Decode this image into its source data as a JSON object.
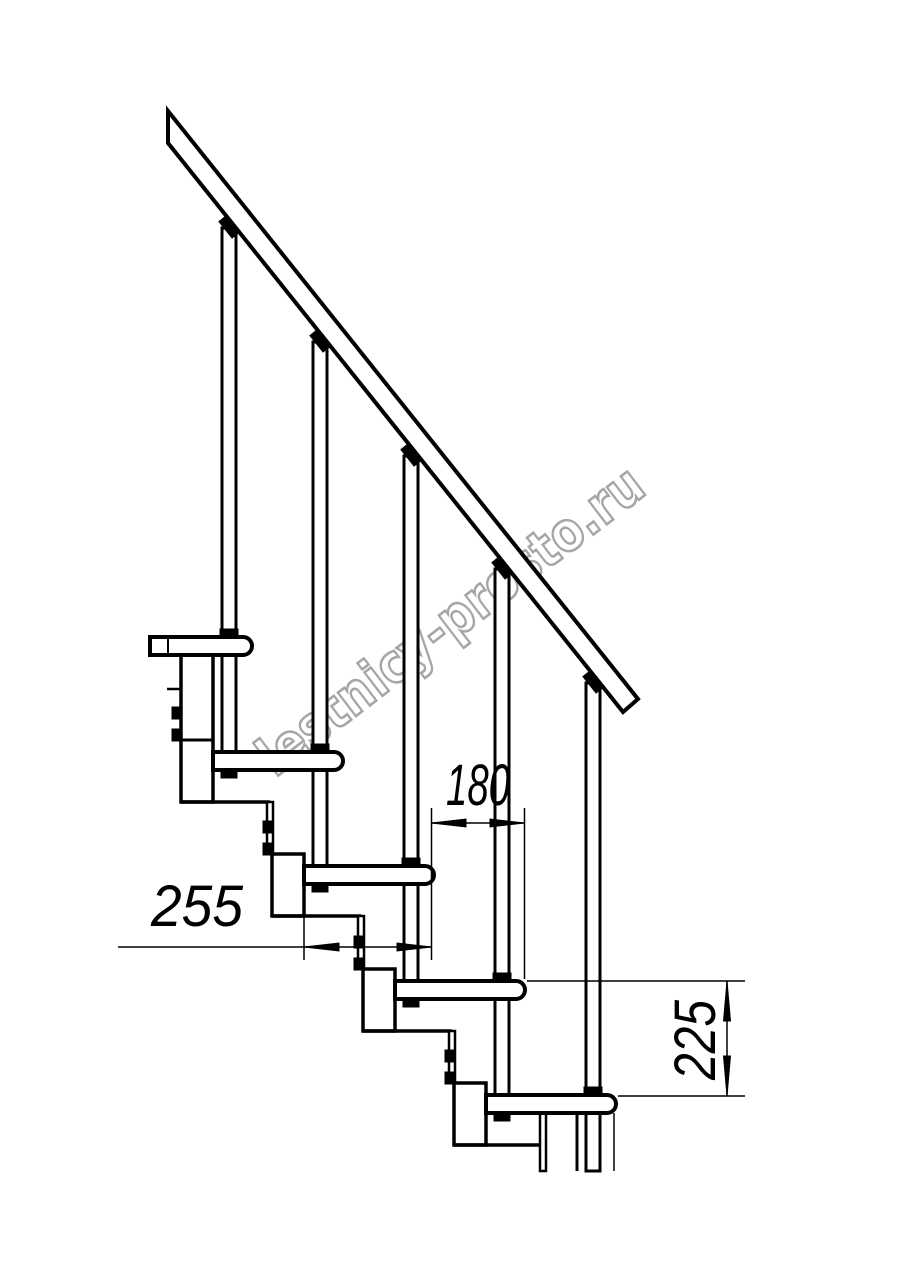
{
  "watermark": {
    "text": "lestnicy-prosto.ru",
    "color": "#a6a6a6",
    "fill": "#ffffff",
    "x": 275,
    "y": 778,
    "angle": -37.4,
    "font_size": 54,
    "text_length": 470,
    "stroke_width": 2.6
  },
  "drawing": {
    "line_color": "#000000",
    "background": "#ffffff",
    "handrail": {
      "points": "168,111 638,699 623,712 168,143"
    },
    "rail_angle_deg": 51.3,
    "steps": [
      {
        "t": 637,
        "l": 150,
        "r": 252
      },
      {
        "t": 752,
        "l": 213,
        "r": 343
      },
      {
        "t": 866,
        "l": 304,
        "r": 434
      },
      {
        "t": 981,
        "l": 395,
        "r": 525
      },
      {
        "t": 1095,
        "l": 486,
        "r": 616
      }
    ],
    "step_height": 18,
    "nose_radius": 9,
    "balusters": [
      {
        "axis": 229,
        "top": 228,
        "bottom": 754
      },
      {
        "axis": 320,
        "top": 342,
        "bottom": 868
      },
      {
        "axis": 411,
        "top": 456,
        "bottom": 983
      },
      {
        "axis": 502,
        "top": 569,
        "bottom": 1097
      },
      {
        "axis": 593,
        "top": 683,
        "bottom": 1171
      }
    ],
    "columns": [
      {
        "x": 181,
        "y": 655,
        "w": 32,
        "h": 147,
        "mid": 740
      },
      {
        "x": 272,
        "y": 854,
        "w": 32,
        "h": 62
      },
      {
        "x": 363,
        "y": 969,
        "w": 32,
        "h": 62
      },
      {
        "x": 454,
        "y": 1083,
        "w": 32,
        "h": 62
      }
    ],
    "bracket_reach": 89,
    "plates": [
      {
        "x": 267,
        "y": 802,
        "h": 52
      },
      {
        "x": 358,
        "y": 916,
        "h": 53
      },
      {
        "x": 449,
        "y": 1031,
        "h": 52
      },
      {
        "x": 540,
        "y": 1113,
        "h": 58
      }
    ],
    "tabs": [
      [
        172,
        707
      ],
      [
        172,
        729
      ],
      [
        263,
        821
      ],
      [
        263,
        843
      ],
      [
        354,
        936
      ],
      [
        354,
        958
      ],
      [
        445,
        1050
      ],
      [
        445,
        1072
      ]
    ],
    "extra_under": [
      [
        577,
        1113,
        577,
        1171,
        3
      ],
      [
        614,
        1113,
        614,
        1171,
        1.5
      ]
    ],
    "extra_over": [
      [
        167,
        689,
        181,
        689,
        2.5
      ],
      [
        168,
        637,
        168,
        655,
        2
      ]
    ],
    "dimensions": {
      "d180": {
        "label": "180",
        "line": [
          431.5,
          823,
          524.5,
          823
        ],
        "ext": [
          [
            431.5,
            808,
            431.5,
            960
          ],
          [
            524.5,
            808,
            524.5,
            979
          ]
        ],
        "arrows": [
          [
            431.5,
            823,
            466,
            819,
            466,
            827
          ],
          [
            524.5,
            823,
            490,
            819,
            490,
            827
          ]
        ],
        "text": {
          "x": 478,
          "y": 805,
          "len": 64,
          "angle": 0
        }
      },
      "d255": {
        "label": "255",
        "line": [
          118,
          947,
          431.5,
          947
        ],
        "ext": [
          [
            304,
            888,
            304,
            960
          ]
        ],
        "arrows": [
          [
            304,
            947,
            339,
            943,
            339,
            951
          ],
          [
            431.5,
            947,
            397,
            943,
            397,
            951
          ]
        ],
        "text": {
          "x": 197,
          "y": 926,
          "len": 92,
          "angle": 0
        }
      },
      "d225": {
        "label": "225",
        "line": [
          727,
          981,
          727,
          1096
        ],
        "ext": [
          [
            527,
            981,
            745,
            981
          ],
          [
            618,
            1096,
            745,
            1096
          ]
        ],
        "arrows": [
          [
            727,
            981,
            723.5,
            1021,
            730.5,
            1021
          ],
          [
            727,
            1096,
            723.5,
            1056,
            730.5,
            1056
          ]
        ],
        "text": {
          "x": 715,
          "y": 1040,
          "len": 80,
          "angle": -90
        }
      }
    }
  }
}
